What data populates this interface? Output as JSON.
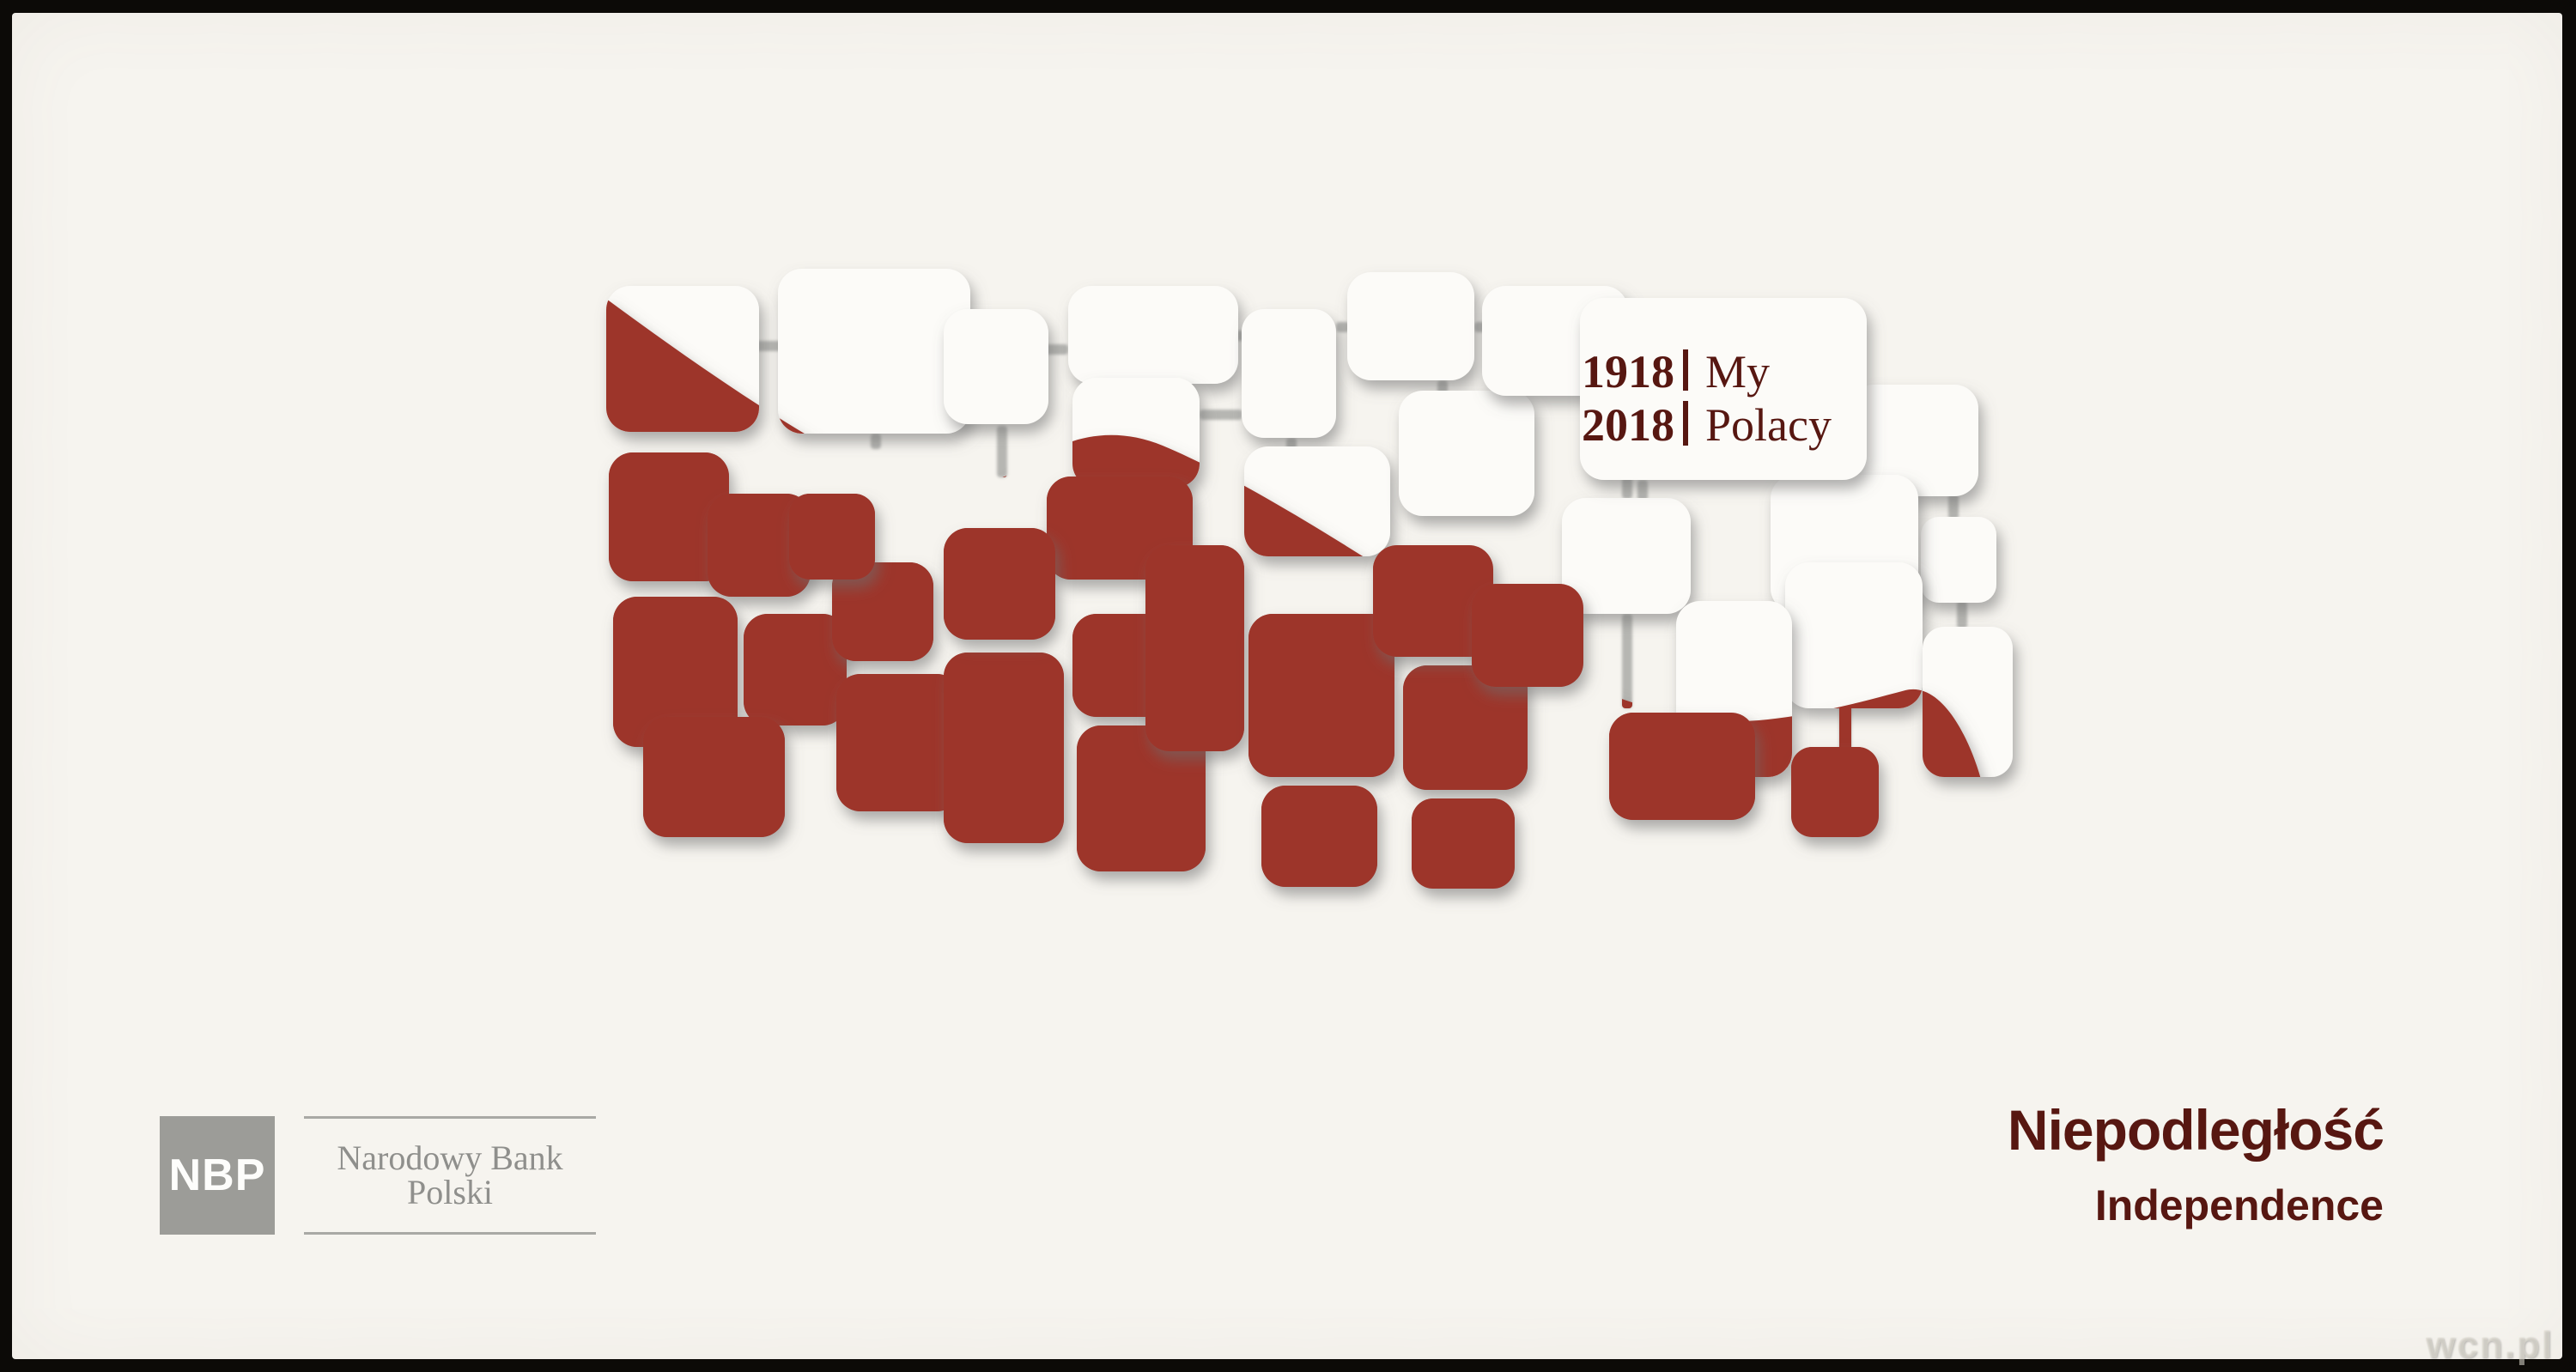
{
  "meta": {
    "title_pl": "Niepodległość",
    "title_en": "Independence"
  },
  "badge": {
    "year_top": "1918",
    "year_bottom": "2018",
    "label_top": "My",
    "label_bottom": "Polacy"
  },
  "nbp": {
    "logo": "NBP",
    "bank_name": "Narodowy Bank Polski"
  },
  "watermark": "wcn.pl",
  "colors": {
    "card": "#f6f4ef",
    "tile-white": "#fcfbf8",
    "red": "#9d3529",
    "maroon": "#571711",
    "logo-gray": "#9c9c98",
    "logo-text": "#8f8f8c",
    "rule": "#a9a9a5",
    "connector": "#b6b6b2",
    "wm": "rgba(225,222,212,0.55)"
  },
  "mosaic": {
    "white_tiles": [
      [
        692,
        318,
        178,
        170
      ],
      [
        892,
        298,
        224,
        192
      ],
      [
        1085,
        345,
        122,
        134
      ],
      [
        1230,
        318,
        198,
        114
      ],
      [
        1235,
        425,
        148,
        128
      ],
      [
        1432,
        345,
        110,
        150
      ],
      [
        1555,
        302,
        148,
        126
      ],
      [
        1435,
        505,
        170,
        128
      ],
      [
        1615,
        440,
        158,
        146
      ],
      [
        1712,
        318,
        170,
        128
      ],
      [
        2140,
        433,
        150,
        130
      ],
      [
        2223,
        587,
        88,
        100
      ],
      [
        1805,
        565,
        150,
        135
      ],
      [
        2048,
        538,
        172,
        160
      ],
      [
        2065,
        640,
        160,
        170
      ],
      [
        2225,
        715,
        105,
        175
      ],
      [
        1938,
        685,
        135,
        205
      ],
      [
        1826,
        332,
        334,
        212
      ]
    ],
    "red_tiles": [
      [
        695,
        512,
        140,
        150
      ],
      [
        810,
        560,
        120,
        120
      ],
      [
        700,
        680,
        145,
        175
      ],
      [
        852,
        700,
        120,
        130
      ],
      [
        735,
        820,
        165,
        140
      ],
      [
        955,
        640,
        118,
        115
      ],
      [
        960,
        770,
        145,
        160
      ],
      [
        1085,
        745,
        140,
        222
      ],
      [
        1205,
        540,
        170,
        120
      ],
      [
        1235,
        700,
        120,
        120
      ],
      [
        1240,
        830,
        150,
        170
      ],
      [
        1320,
        620,
        115,
        240
      ],
      [
        1440,
        700,
        170,
        190
      ],
      [
        1455,
        900,
        135,
        118
      ],
      [
        1620,
        760,
        145,
        145
      ],
      [
        1630,
        915,
        120,
        105
      ],
      [
        1860,
        815,
        170,
        125
      ],
      [
        2072,
        855,
        102,
        105
      ],
      [
        905,
        560,
        100,
        100
      ],
      [
        1085,
        600,
        130,
        130
      ],
      [
        1585,
        620,
        140,
        130
      ],
      [
        1700,
        665,
        130,
        120
      ]
    ],
    "connectors": [
      [
        860,
        382,
        48,
        12
      ],
      [
        1116,
        386,
        114,
        12
      ],
      [
        1416,
        370,
        24,
        12
      ],
      [
        1542,
        360,
        16,
        12
      ],
      [
        1703,
        360,
        14,
        12
      ],
      [
        1484,
        495,
        12,
        14
      ],
      [
        1660,
        428,
        12,
        16
      ],
      [
        1875,
        446,
        12,
        120
      ],
      [
        1893,
        544,
        12,
        24
      ],
      [
        2255,
        560,
        12,
        30
      ],
      [
        2265,
        685,
        12,
        32
      ],
      [
        1875,
        700,
        12,
        110
      ],
      [
        2128,
        800,
        14,
        60
      ],
      [
        1000,
        490,
        12,
        18
      ],
      [
        1147,
        481,
        12,
        60
      ],
      [
        1383,
        462,
        50,
        12
      ]
    ],
    "wave_path": "M 688 330 C 780 398 880 468 975 520 C 1060 566 1125 562 1192 522 C 1228 494 1282 480 1340 504 C 1440 546 1560 625 1680 700 C 1780 764 1872 806 1960 822 C 2040 835 2140 806 2205 789 C 2248 778 2282 848 2295 900 C 2260 918 2200 924 2130 928 C 2060 933 1990 940 1930 947 C 1830 962 1740 995 1650 1018 C 1550 1040 1450 1052 1350 1056 L 688 1056 Z"
  }
}
